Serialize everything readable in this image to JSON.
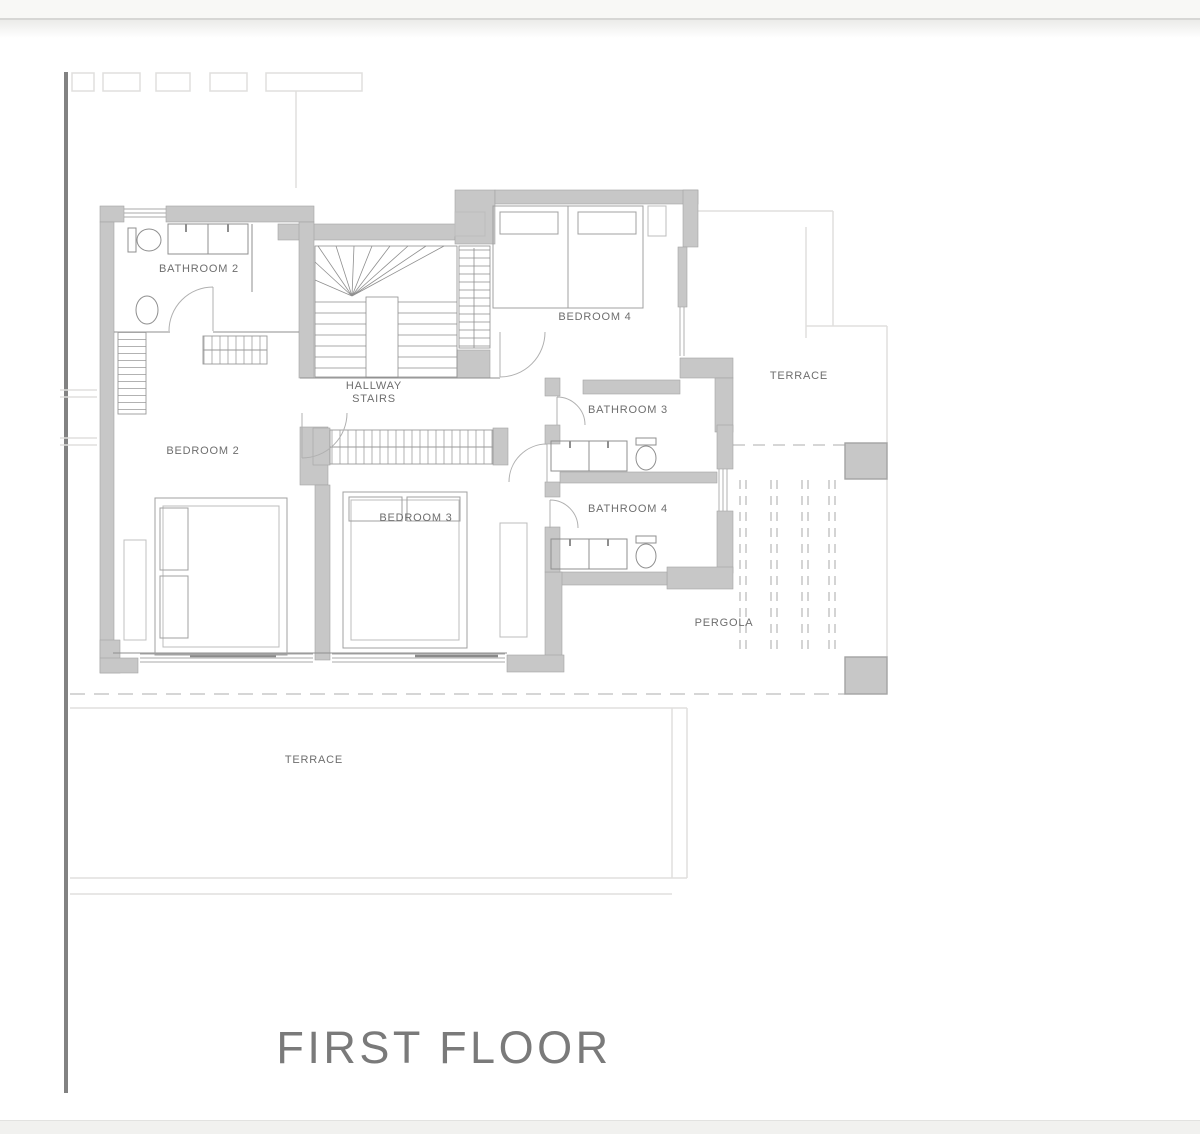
{
  "page": {
    "floor_title": "FIRST FLOOR"
  },
  "plan": {
    "rooms": [
      {
        "id": "bathroom-2",
        "label": "BATHROOM 2"
      },
      {
        "id": "bedroom-2",
        "label": "BEDROOM 2"
      },
      {
        "id": "hallway-stairs",
        "label_line1": "HALLWAY",
        "label_line2": "STAIRS"
      },
      {
        "id": "bedroom-3",
        "label": "BEDROOM 3"
      },
      {
        "id": "bedroom-4",
        "label": "BEDROOM 4"
      },
      {
        "id": "bathroom-3",
        "label": "BATHROOM 3"
      },
      {
        "id": "bathroom-4",
        "label": "BATHROOM 4"
      },
      {
        "id": "terrace-upper",
        "label": "TERRACE"
      },
      {
        "id": "pergola",
        "label": "PERGOLA"
      },
      {
        "id": "terrace-lower",
        "label": "TERRACE"
      }
    ]
  },
  "colors": {
    "wall_fill": "#c7c7c7",
    "wall_edge": "#a3a3a3",
    "line": "#8f8f8f",
    "faint": "#e0dfdd",
    "dash": "#bdbdbd",
    "text": "#6e6e6e",
    "title": "#7a7a7a",
    "page_bg": "#ffffff",
    "sideline": "#828282",
    "footer_bar": "#f1f1ef"
  }
}
